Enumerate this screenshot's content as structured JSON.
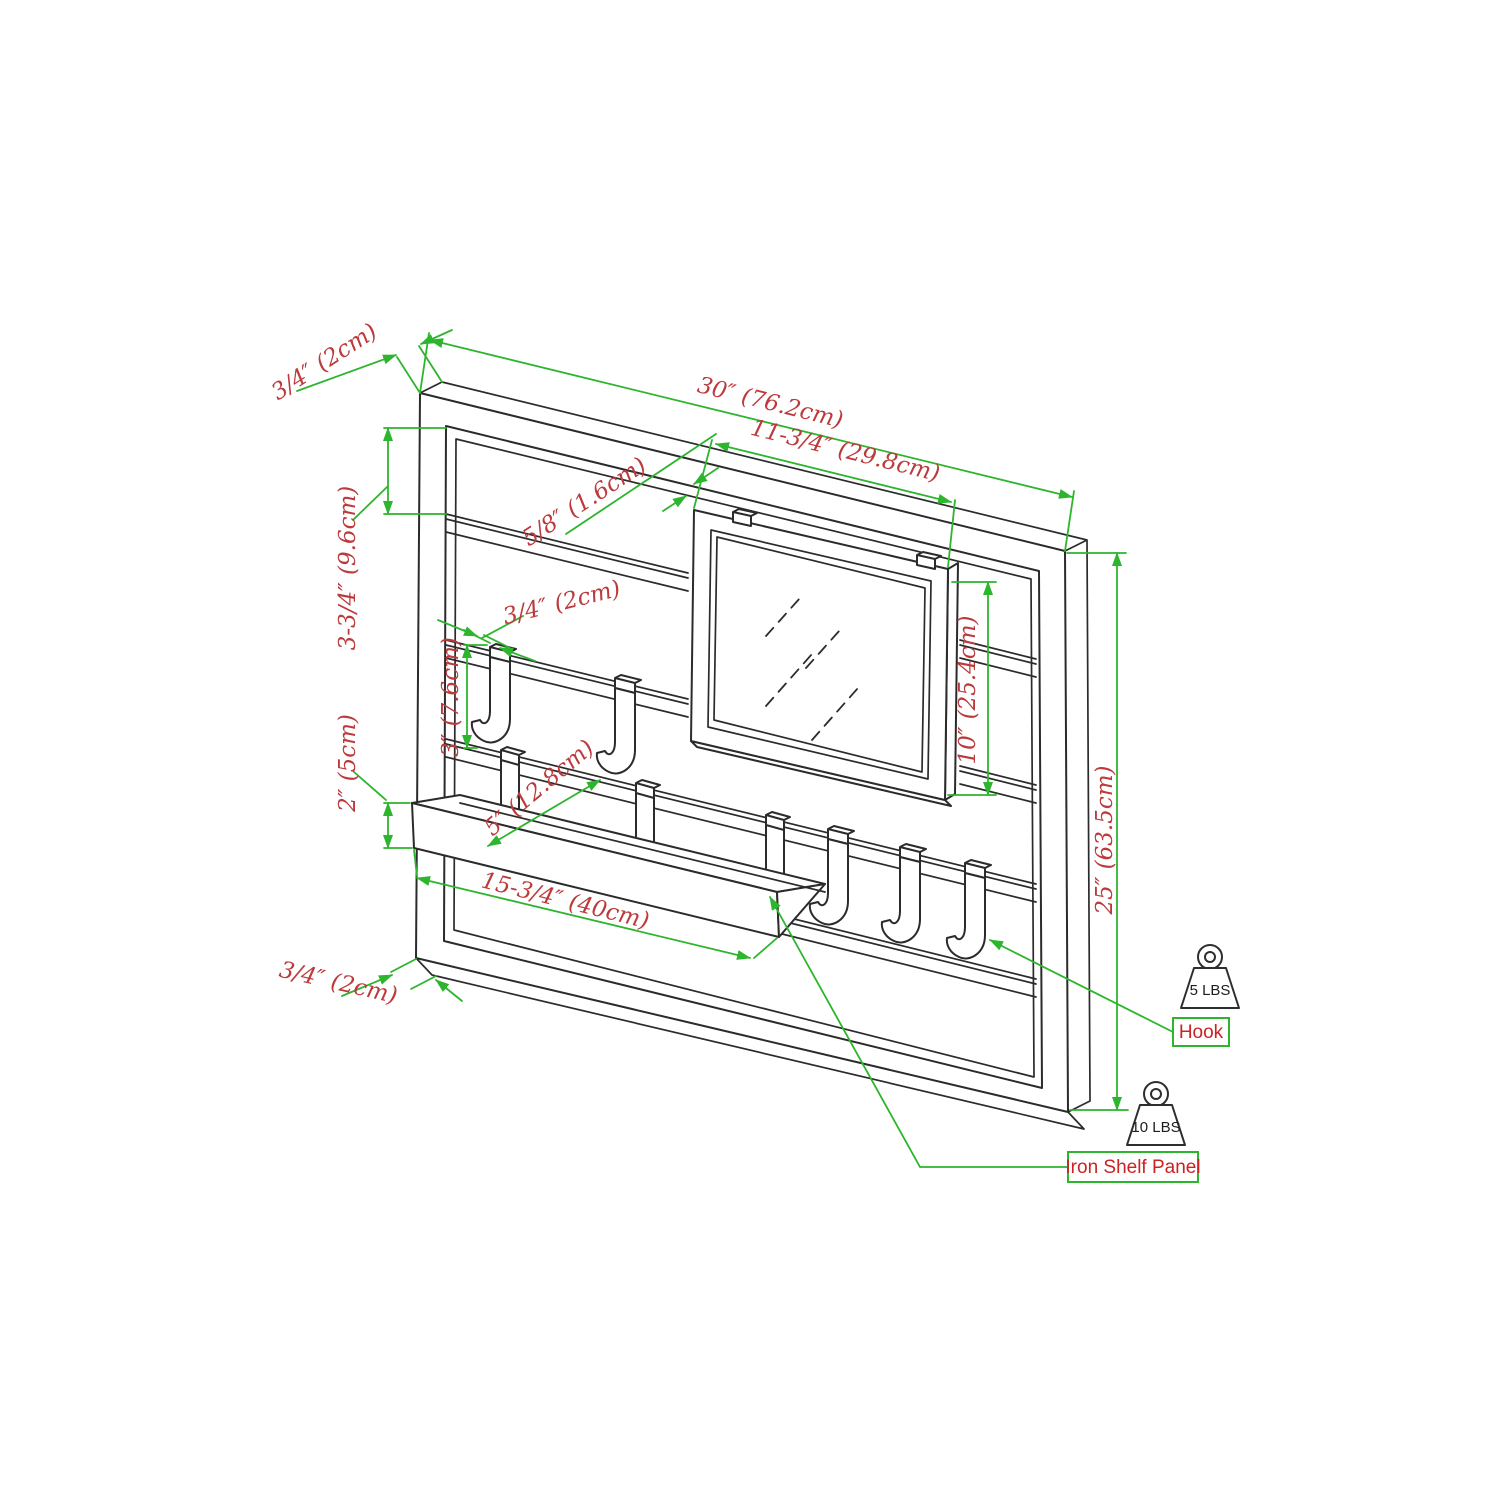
{
  "drawing": {
    "dimensions": {
      "frame_thickness_top": "3/4″ (2cm)",
      "overall_width": "30″ (76.2cm)",
      "mirror_width": "11-3/4″ (29.8cm)",
      "slat_thickness": "5/8″ (1.6cm)",
      "top_slat_spacing": "3-3/4″ (9.6cm)",
      "hook_width": "3/4″ (2cm)",
      "hook_height": "3″ (7.6cm)",
      "shelf_lip_height": "2″ (5cm)",
      "shelf_depth": "5″ (12.8cm)",
      "shelf_length": "15-3/4″ (40cm)",
      "mirror_height": "10″ (25.4cm)",
      "overall_height": "25″ (63.5cm)",
      "frame_thickness_bottom": "3/4″ (2cm)"
    },
    "callouts": {
      "hook": "Hook",
      "shelf": "Iron Shelf Panel"
    },
    "load_ratings": {
      "hook_capacity": "5 LBS",
      "shelf_capacity": "10 LBS"
    },
    "colors": {
      "dimension_line": "#2db52d",
      "dimension_text": "#bc3a3c",
      "callout_text": "#cc2222",
      "line_art": "#2b2b2b"
    }
  }
}
